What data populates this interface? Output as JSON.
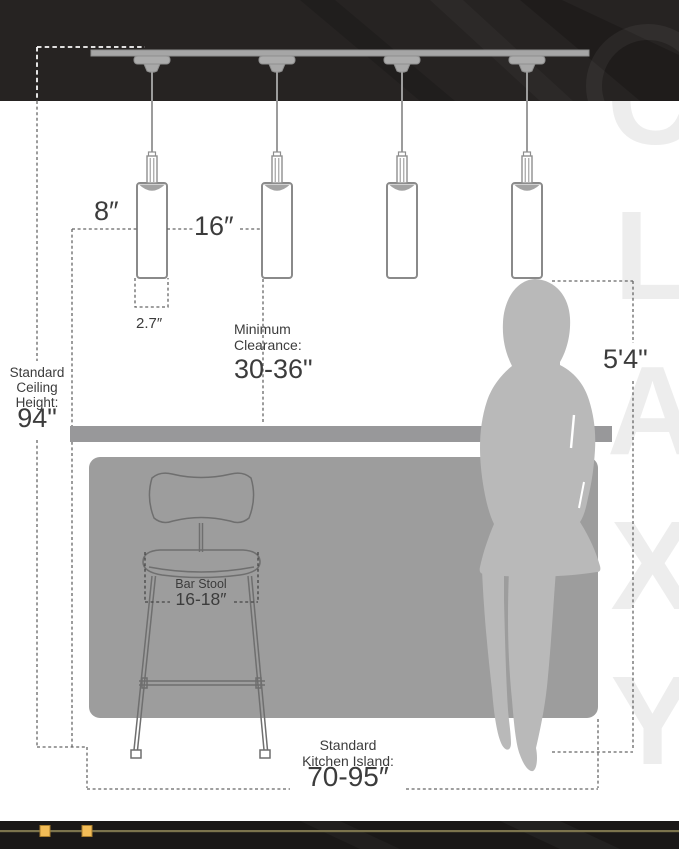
{
  "colors": {
    "band": "#262322",
    "footer": "#1a1817",
    "gold": "#f2bc57",
    "gold_dark": "#a87d2c",
    "gold_line": "#7c744d",
    "line_gray": "#8f8f8f",
    "fixture_gray": "#a6a6a6",
    "island": "#9d9d9d",
    "counter": "#98989a",
    "person": "#b9b9b9",
    "dash": "#666666",
    "text": "#3c3c3c",
    "watermark": "#ededed"
  },
  "labels": {
    "pendant_offset": "8″",
    "pendant_spacing": "16″",
    "pendant_width": "2.7″",
    "clearance_line1": "Minimum",
    "clearance_line2": "Clearance:",
    "clearance_value": "30-36\"",
    "ceiling_line1": "Standard",
    "ceiling_line2": "Ceiling",
    "ceiling_line3": "Height:",
    "ceiling_value": "94\"",
    "person_height": "5'4\"",
    "stool_label": "Bar Stool",
    "stool_value": "16-18″",
    "island_line1": "Standard",
    "island_line2": "Kitchen Island:",
    "island_value": "70-95″"
  },
  "watermark": "CLAXY"
}
